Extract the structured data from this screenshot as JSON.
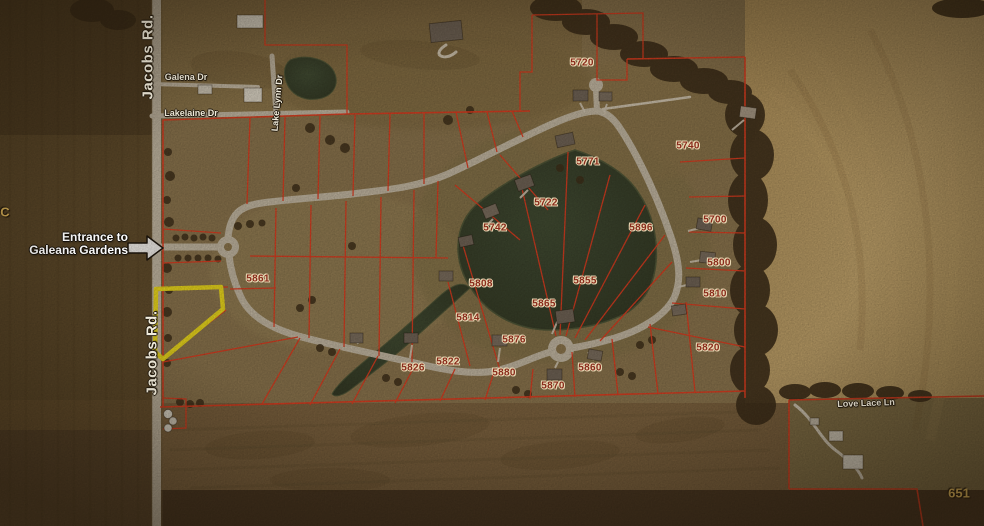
{
  "map": {
    "title": "Galeana Gardens subdivision aerial plat map",
    "colors": {
      "boundary_red": "#e8391f",
      "highlight_yellow": "#f6e41c",
      "lot_number_red": "#8a2b1b",
      "road_label_white": "#f3eede",
      "gold_label": "#c9a452",
      "pond_green": "#333f2b",
      "road_gray": "#c9c0ae"
    },
    "entrance_callout": {
      "line1": "Entrance to",
      "line2": "Galeana Gardens"
    },
    "road_labels": [
      {
        "id": "jacobs-rd-top",
        "text": "Jacobs Rd.",
        "x": 148,
        "y": 57,
        "rot": -90,
        "big": true
      },
      {
        "id": "jacobs-rd-bottom",
        "text": "Jacobs Rd.",
        "x": 152,
        "y": 353,
        "rot": -90,
        "big": true
      },
      {
        "id": "galena-dr",
        "text": "Galena Dr",
        "x": 186,
        "y": 77,
        "rot": 0,
        "big": false
      },
      {
        "id": "lakelaine-dr",
        "text": "Lakelaine Dr",
        "x": 191,
        "y": 113,
        "rot": 0,
        "big": false
      },
      {
        "id": "lake-lynn-dr",
        "text": "Lake Lynn Dr",
        "x": 277,
        "y": 103,
        "rot": -85,
        "big": false
      },
      {
        "id": "love-lace-ln",
        "text": "Love Lace Ln",
        "x": 866,
        "y": 403,
        "rot": -2,
        "big": false
      }
    ],
    "lot_labels": [
      {
        "text": "5720",
        "x": 582,
        "y": 63
      },
      {
        "text": "5771",
        "x": 588,
        "y": 162
      },
      {
        "text": "5740",
        "x": 688,
        "y": 146
      },
      {
        "text": "5722",
        "x": 546,
        "y": 203
      },
      {
        "text": "5742",
        "x": 495,
        "y": 228
      },
      {
        "text": "5896",
        "x": 641,
        "y": 228
      },
      {
        "text": "5700",
        "x": 715,
        "y": 220
      },
      {
        "text": "5800",
        "x": 719,
        "y": 263
      },
      {
        "text": "5810",
        "x": 715,
        "y": 294
      },
      {
        "text": "5820",
        "x": 708,
        "y": 348
      },
      {
        "text": "5861",
        "x": 258,
        "y": 279
      },
      {
        "text": "5808",
        "x": 481,
        "y": 284
      },
      {
        "text": "5855",
        "x": 585,
        "y": 281
      },
      {
        "text": "5865",
        "x": 544,
        "y": 304
      },
      {
        "text": "5814",
        "x": 468,
        "y": 318
      },
      {
        "text": "5876",
        "x": 514,
        "y": 340
      },
      {
        "text": "5822",
        "x": 448,
        "y": 362
      },
      {
        "text": "5826",
        "x": 413,
        "y": 368
      },
      {
        "text": "5880",
        "x": 504,
        "y": 373
      },
      {
        "text": "5860",
        "x": 590,
        "y": 368
      },
      {
        "text": "5870",
        "x": 553,
        "y": 386
      }
    ],
    "corner_labels": [
      {
        "id": "partial-letter-c",
        "text": "C",
        "x": 5,
        "y": 212
      },
      {
        "id": "parcel-651",
        "text": "651",
        "x": 959,
        "y": 493
      }
    ]
  }
}
